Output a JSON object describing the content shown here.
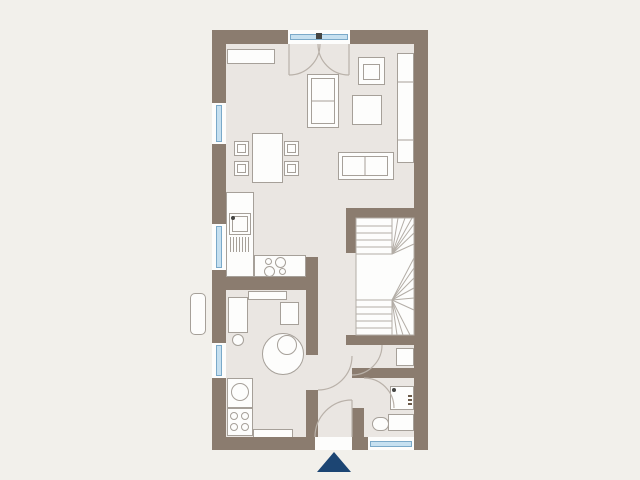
{
  "colors": {
    "background": "#f2f0eb",
    "wall": "#8b7c6f",
    "floor": "#eae6e2",
    "white": "#fdfdfc",
    "line": "#a6a099",
    "glass": "#c6e0f0",
    "glass_edge": "#7aa9c9",
    "navy": "#1c4573",
    "dot": "#454543",
    "stair_line": "#b3ada6",
    "arc": "#b9b1a9"
  },
  "plan": {
    "floor": {
      "x": 226,
      "y": 44,
      "w": 188,
      "h": 393
    },
    "walls": [
      {
        "name": "wall-top-left",
        "x": 212,
        "y": 30,
        "w": 76,
        "h": 14
      },
      {
        "name": "wall-top-right",
        "x": 350,
        "y": 30,
        "w": 78,
        "h": 14
      },
      {
        "name": "wall-left",
        "x": 212,
        "y": 30,
        "w": 14,
        "h": 420
      },
      {
        "name": "wall-right",
        "x": 414,
        "y": 30,
        "w": 14,
        "h": 420
      },
      {
        "name": "wall-bottom-left",
        "x": 212,
        "y": 437,
        "w": 103,
        "h": 13
      },
      {
        "name": "wall-bottom-pier",
        "x": 352,
        "y": 437,
        "w": 16,
        "h": 13
      },
      {
        "name": "wall-stair-top",
        "x": 346,
        "y": 208,
        "w": 82,
        "h": 10
      },
      {
        "name": "wall-stair-left",
        "x": 346,
        "y": 208,
        "w": 10,
        "h": 45
      },
      {
        "name": "wall-stair-bottom",
        "x": 346,
        "y": 335,
        "w": 82,
        "h": 10
      },
      {
        "name": "wall-wc-top",
        "x": 352,
        "y": 368,
        "w": 76,
        "h": 10
      },
      {
        "name": "wall-wc-pier",
        "x": 352,
        "y": 408,
        "w": 12,
        "h": 29
      },
      {
        "name": "wall-utility-upper",
        "x": 306,
        "y": 257,
        "w": 12,
        "h": 98
      },
      {
        "name": "wall-utility-lower",
        "x": 306,
        "y": 390,
        "w": 12,
        "h": 47
      },
      {
        "name": "wall-kitchen",
        "x": 226,
        "y": 277,
        "w": 80,
        "h": 13
      }
    ],
    "windows": [
      {
        "name": "window-left-1",
        "x": 212,
        "y": 103,
        "w": 14,
        "h": 41,
        "dir": "v"
      },
      {
        "name": "window-left-2",
        "x": 212,
        "y": 224,
        "w": 14,
        "h": 46,
        "dir": "v"
      },
      {
        "name": "window-left-3",
        "x": 212,
        "y": 343,
        "w": 14,
        "h": 35,
        "dir": "v"
      },
      {
        "name": "window-wc",
        "x": 368,
        "y": 437,
        "w": 46,
        "h": 13,
        "dir": "h"
      },
      {
        "name": "french-door-glass",
        "x": 288,
        "y": 30,
        "w": 62,
        "h": 14,
        "dir": "h"
      }
    ],
    "furniture": [
      {
        "name": "sideboard",
        "x": 227,
        "y": 49,
        "w": 48,
        "h": 15
      },
      {
        "name": "sofa-vertical",
        "x": 307,
        "y": 74,
        "w": 32,
        "h": 54
      },
      {
        "name": "sofa-vertical-cushion",
        "x": 311,
        "y": 78,
        "w": 24,
        "h": 46,
        "fill": "none"
      },
      {
        "name": "armchair",
        "x": 358,
        "y": 57,
        "w": 27,
        "h": 28
      },
      {
        "name": "armchair-seat",
        "x": 363,
        "y": 64,
        "w": 17,
        "h": 16,
        "fill": "none"
      },
      {
        "name": "side-table",
        "x": 352,
        "y": 95,
        "w": 30,
        "h": 30
      },
      {
        "name": "wall-cabinet",
        "x": 397,
        "y": 53,
        "w": 17,
        "h": 110
      },
      {
        "name": "sofa-horizontal",
        "x": 338,
        "y": 152,
        "w": 56,
        "h": 28
      },
      {
        "name": "sofa-horizontal-cushion",
        "x": 342,
        "y": 156,
        "w": 46,
        "h": 20,
        "fill": "none"
      },
      {
        "name": "dining-table",
        "x": 252,
        "y": 133,
        "w": 31,
        "h": 50
      },
      {
        "name": "dining-chair",
        "x": 234,
        "y": 141,
        "w": 15,
        "h": 15,
        "cls": "chair"
      },
      {
        "name": "dining-chair",
        "x": 234,
        "y": 161,
        "w": 15,
        "h": 15,
        "cls": "chair"
      },
      {
        "name": "dining-chair",
        "x": 284,
        "y": 141,
        "w": 15,
        "h": 15,
        "cls": "chair"
      },
      {
        "name": "dining-chair",
        "x": 284,
        "y": 161,
        "w": 15,
        "h": 15,
        "cls": "chair"
      },
      {
        "name": "kitchen-counter-left",
        "x": 226,
        "y": 192,
        "w": 28,
        "h": 85
      },
      {
        "name": "kitchen-counter-bottom",
        "x": 254,
        "y": 255,
        "w": 52,
        "h": 22
      },
      {
        "name": "kitchen-sink",
        "x": 229,
        "y": 213,
        "w": 22,
        "h": 22
      },
      {
        "name": "kitchen-sink-basin",
        "x": 232,
        "y": 216,
        "w": 16,
        "h": 16,
        "fill": "none"
      },
      {
        "name": "utility-desk",
        "x": 228,
        "y": 297,
        "w": 20,
        "h": 36
      },
      {
        "name": "utility-shelf-square",
        "x": 280,
        "y": 302,
        "w": 19,
        "h": 23
      },
      {
        "name": "washing-machine",
        "x": 227,
        "y": 378,
        "w": 26,
        "h": 30
      },
      {
        "name": "laundry-unit",
        "x": 227,
        "y": 408,
        "w": 26,
        "h": 28
      },
      {
        "name": "utility-bench",
        "x": 253,
        "y": 429,
        "w": 40,
        "h": 9
      },
      {
        "name": "utility-shelf-top",
        "x": 248,
        "y": 291,
        "w": 39,
        "h": 9
      },
      {
        "name": "hall-niche",
        "x": 396,
        "y": 348,
        "w": 18,
        "h": 18
      },
      {
        "name": "wc-sink",
        "x": 390,
        "y": 386,
        "w": 24,
        "h": 24
      },
      {
        "name": "toilet-cistern",
        "x": 388,
        "y": 414,
        "w": 26,
        "h": 17
      },
      {
        "name": "toilet-bowl",
        "x": 372,
        "y": 417,
        "w": 17,
        "h": 14,
        "rx": 7
      },
      {
        "name": "exterior-element",
        "x": 190,
        "y": 293,
        "w": 16,
        "h": 42,
        "rx": 5
      },
      {
        "name": "entrance-threshold",
        "x": 315,
        "y": 437,
        "w": 37,
        "h": 13,
        "cls": "open"
      }
    ],
    "circles": [
      {
        "name": "boiler",
        "cx": 283,
        "cy": 354,
        "r": 21
      },
      {
        "name": "boiler-inner",
        "cx": 287,
        "cy": 345,
        "r": 10
      },
      {
        "name": "desk-chair",
        "cx": 238,
        "cy": 340,
        "r": 6
      },
      {
        "name": "washer-drum",
        "cx": 240,
        "cy": 392,
        "r": 9
      },
      {
        "name": "laundry-knob",
        "cx": 234,
        "cy": 416,
        "r": 4
      },
      {
        "name": "laundry-knob",
        "cx": 245,
        "cy": 416,
        "r": 4
      },
      {
        "name": "laundry-knob",
        "cx": 234,
        "cy": 427,
        "r": 4
      },
      {
        "name": "laundry-knob",
        "cx": 245,
        "cy": 427,
        "r": 4
      },
      {
        "name": "cooktop-burner",
        "cx": 268,
        "cy": 261,
        "r": 3.5
      },
      {
        "name": "cooktop-burner",
        "cx": 280,
        "cy": 262,
        "r": 5.5
      },
      {
        "name": "cooktop-burner",
        "cx": 269,
        "cy": 271,
        "r": 5.5
      },
      {
        "name": "cooktop-burner",
        "cx": 282,
        "cy": 271,
        "r": 3.5
      },
      {
        "name": "kitchen-faucet-dot",
        "cx": 233,
        "cy": 218,
        "r": 2,
        "fill": "dark"
      },
      {
        "name": "wc-faucet-dot",
        "cx": 394,
        "cy": 390,
        "r": 2,
        "fill": "dark"
      }
    ],
    "hatch": {
      "name": "sink-drainer",
      "x": 230,
      "y": 237,
      "len": 15,
      "count": 7,
      "step": 3
    },
    "marks": [
      {
        "name": "french-door-pivot",
        "x": 316,
        "y": 33,
        "w": 6,
        "h": 6,
        "color": "#454543"
      },
      {
        "name": "wc-label-mark",
        "x": 408,
        "y": 395,
        "w": 4,
        "h": 2,
        "color": "#6a5948"
      },
      {
        "name": "wc-label-mark",
        "x": 408,
        "y": 399,
        "w": 4,
        "h": 2,
        "color": "#6a5948"
      },
      {
        "name": "wc-label-mark",
        "x": 408,
        "y": 403,
        "w": 4,
        "h": 2,
        "color": "#6a5948"
      }
    ],
    "stairs": {
      "box": {
        "x": 356,
        "y": 218,
        "w": 58,
        "h": 117
      },
      "lines": [
        [
          356,
          226,
          392,
          226
        ],
        [
          356,
          233,
          392,
          233
        ],
        [
          356,
          240,
          392,
          240
        ],
        [
          356,
          247,
          392,
          247
        ],
        [
          392,
          218,
          392,
          254
        ],
        [
          356,
          254,
          392,
          254
        ],
        [
          392,
          254,
          398,
          218
        ],
        [
          392,
          254,
          405,
          218
        ],
        [
          392,
          254,
          412,
          218
        ],
        [
          392,
          254,
          414,
          224
        ],
        [
          392,
          254,
          414,
          233
        ],
        [
          392,
          254,
          414,
          244
        ],
        [
          392,
          300,
          414,
          258
        ],
        [
          392,
          300,
          414,
          268
        ],
        [
          392,
          300,
          414,
          278
        ],
        [
          392,
          300,
          414,
          288
        ],
        [
          392,
          300,
          414,
          298
        ],
        [
          392,
          300,
          414,
          310
        ],
        [
          392,
          300,
          410,
          335
        ],
        [
          392,
          300,
          403,
          335
        ],
        [
          392,
          300,
          397,
          335
        ],
        [
          392,
          300,
          392,
          335
        ],
        [
          356,
          300,
          392,
          300
        ],
        [
          356,
          307,
          392,
          307
        ],
        [
          356,
          314,
          392,
          314
        ],
        [
          356,
          321,
          392,
          321
        ],
        [
          356,
          328,
          392,
          328
        ]
      ]
    },
    "divider_lines": [
      [
        397,
        82,
        414,
        82
      ],
      [
        397,
        140,
        414,
        140
      ],
      [
        311,
        101,
        335,
        101
      ],
      [
        365,
        156,
        365,
        176
      ]
    ],
    "leaf_lines": [
      [
        289,
        44,
        289,
        75
      ],
      [
        349,
        44,
        349,
        75
      ],
      [
        352,
        400,
        352,
        437
      ]
    ],
    "arcs": [
      {
        "name": "french-door-left-swing",
        "d": "M 320 44 A 31 31 0 0 1 289 75"
      },
      {
        "name": "french-door-right-swing",
        "d": "M 318 44 A 31 31 0 0 0 349 75"
      },
      {
        "name": "utility-door-swing",
        "d": "M 352 356 A 34 34 0 0 1 318 390"
      },
      {
        "name": "stair-door-swing",
        "d": "M 382 345 A 30 30 0 0 1 352 375"
      },
      {
        "name": "wc-door-swing",
        "d": "M 364 378 A 30 30 0 0 1 394 408"
      },
      {
        "name": "entrance-door-swing",
        "d": "M 315 437 A 37 37 0 0 1 352 400"
      }
    ],
    "entrance_marker": {
      "name": "entrance-marker",
      "points": "334,452 317,472 351,472"
    }
  }
}
